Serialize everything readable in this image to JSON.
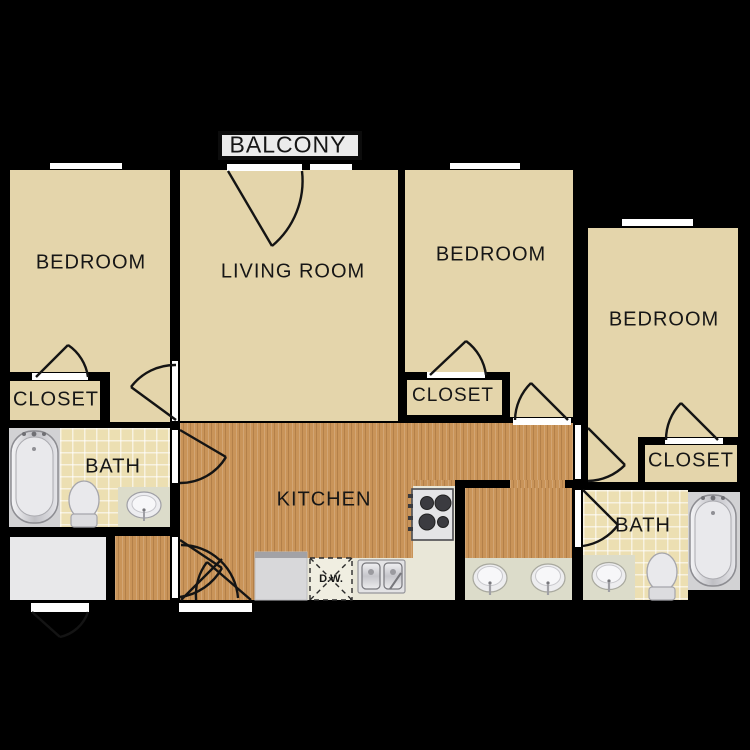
{
  "plan": {
    "type": "apartment-floor-plan",
    "background_color": "#000000",
    "rooms": {
      "balcony": {
        "label": "BALCONY"
      },
      "living_room": {
        "label": "LIVING ROOM"
      },
      "kitchen": {
        "label": "KITCHEN"
      },
      "bedroom_left": {
        "label": "BEDROOM"
      },
      "bedroom_middle": {
        "label": "BEDROOM"
      },
      "bedroom_right": {
        "label": "BEDROOM"
      },
      "bath_left": {
        "label": "BATH"
      },
      "bath_right": {
        "label": "BATH"
      },
      "closet_left": {
        "label": "CLOSET"
      },
      "closet_middle": {
        "label": "CLOSET"
      },
      "closet_right": {
        "label": "CLOSET"
      },
      "dishwasher": {
        "label": "D.W."
      }
    },
    "colors": {
      "wall": "#0c0c0c",
      "room_beige": "#e4d5ab",
      "wood_floor": "#c99459",
      "tile_floor": "#ecdfb2",
      "kitchen_counter": "#e9e7d8",
      "vanity_counter": "#dcdcca",
      "white_room": "#e8e8ea",
      "opening": "#ffffff",
      "balcony_fill": "#ebebeb"
    },
    "fixtures": [
      "bathtub",
      "toilet",
      "sink",
      "stove",
      "refrigerator",
      "dishwasher",
      "double-kitchen-sink",
      "double-vanity-sink"
    ]
  }
}
